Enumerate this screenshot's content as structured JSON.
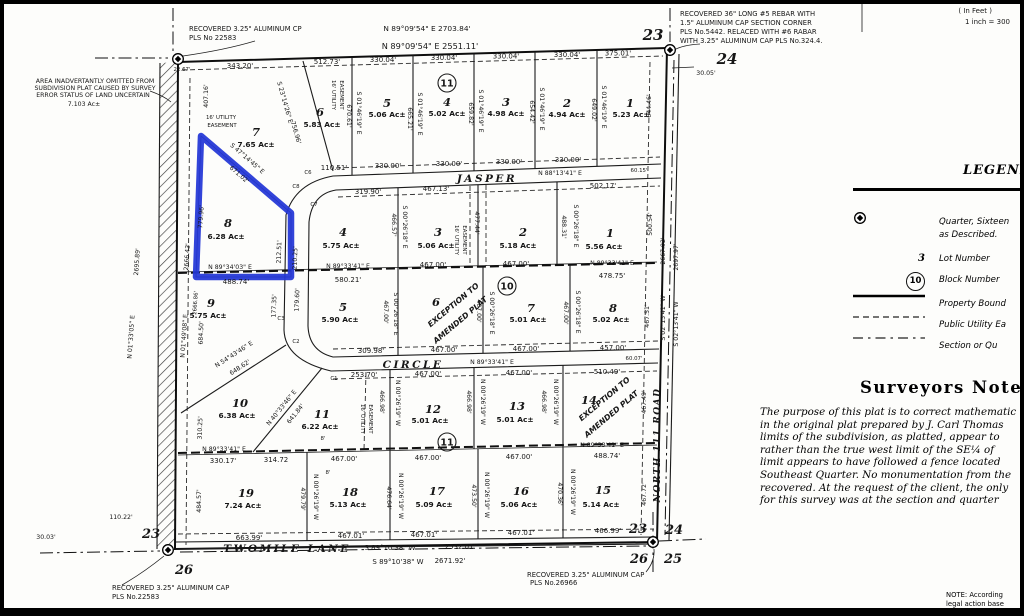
{
  "colors": {
    "highlight": "#2236d6"
  },
  "scale": {
    "l1": "( In Feet )",
    "l2": "1 inch = 300"
  },
  "notes": {
    "tl1": "RECOVERED 3.25\" ALUMINUM CP",
    "tl2": "PLS No 22583",
    "tr1": "RECOVERED 36\" LONG #5 REBAR WITH",
    "tr2": "1.5\" ALUMINUM CAP SECTION CORNER",
    "tr3": "PLS No.5442. RELACED WITH #6 RABAR",
    "tr4": "WITH 3.25\" ALUMINUM CAP PLS No.324.4.",
    "bl1": "RECOVERED 3.25\" ALUMINUM CAP",
    "bl2": "PLS No.22583",
    "br1": "RECOVERED 3.25\" ALUMINUM CAP",
    "br2": "PLS No.26966",
    "om1": "AREA INADVERTANTLY OMITTED FROM",
    "om2": "SUBDIVISION PLAT CAUSED BY SURVEY",
    "om3": "ERROR  STATUS OF LAND UNCERTAIN",
    "om4": "7.103 Ac±",
    "note_br1": "NOTE: According",
    "note_br2": "legal action base"
  },
  "sec": {
    "n23": "23",
    "n24": "24",
    "n25": "25",
    "n26": "26"
  },
  "streets": {
    "jasper": "JASPER",
    "circle": "CIRCLE",
    "twomile": "TWOMILE LANE",
    "north111": "NORTH 111 ROAD"
  },
  "blocks": {
    "b11": "11",
    "b10": "10"
  },
  "exception": {
    "l1": "EXCEPTION TO",
    "l2": "AMENDED PLAT"
  },
  "easement": {
    "l1": "16' UTILITY",
    "l2": "EASEMENT",
    "w8": "8'"
  },
  "lots": {
    "b11_7": {
      "n": "7",
      "a": "7.65 Ac±"
    },
    "b11_6": {
      "n": "6",
      "a": "5.83 Ac±"
    },
    "b11_5": {
      "n": "5",
      "a": "5.06 Ac±"
    },
    "b11_4": {
      "n": "4",
      "a": "5.02 Ac±"
    },
    "b11_3": {
      "n": "3",
      "a": "4.98 Ac±"
    },
    "b11_2": {
      "n": "2",
      "a": "4.94 Ac±"
    },
    "b11_1": {
      "n": "1",
      "a": "5.23 Ac±"
    },
    "r2_8": {
      "n": "8",
      "a": "6.28 Ac±"
    },
    "r2_4": {
      "n": "4",
      "a": "5.75 Ac±"
    },
    "r2_3": {
      "n": "3",
      "a": "5.06 Ac±"
    },
    "r2_2": {
      "n": "2",
      "a": "5.18 Ac±"
    },
    "r2_1": {
      "n": "1",
      "a": "5.56 Ac±"
    },
    "r3_9": {
      "n": "9",
      "a": "5.75 Ac±"
    },
    "r3_5": {
      "n": "5",
      "a": "5.90 Ac±"
    },
    "r3_6": {
      "n": "6"
    },
    "r3_7": {
      "n": "7",
      "a": "5.01 Ac±"
    },
    "r3_8": {
      "n": "8",
      "a": "5.02 Ac±"
    },
    "r4_10": {
      "n": "10",
      "a": "6.38 Ac±"
    },
    "r4_11": {
      "n": "11",
      "a": "6.22 Ac±"
    },
    "r4_12": {
      "n": "12",
      "a": "5.01 Ac±"
    },
    "r4_13": {
      "n": "13",
      "a": "5.01 Ac±"
    },
    "r4_14": {
      "n": "14"
    },
    "r5_19": {
      "n": "19",
      "a": "7.24 Ac±"
    },
    "r5_18": {
      "n": "18",
      "a": "5.13 Ac±"
    },
    "r5_17": {
      "n": "17",
      "a": "5.09 Ac±"
    },
    "r5_16": {
      "n": "16",
      "a": "5.06 Ac±"
    },
    "r5_15": {
      "n": "15",
      "a": "5.14 Ac±"
    }
  },
  "vals": {
    "n890954e_2703": "N 89°09'54\" E   2703.84'",
    "n890954e_2551": "N 89°09'54\" E   2551.11'",
    "d343_20": "343.20'",
    "d512_73": "512.73'",
    "d330_04": "330.04'",
    "d375_01": "375.01'",
    "d407_16": "407.16'",
    "d22_67": "22.67'",
    "s014619e": "S 01°46'19\" E",
    "d670_61": "670.61'",
    "d665_21": "665.21'",
    "d659_82": "659.82'",
    "d654_42": "654.42'",
    "d649_02": "649.02'",
    "d644_46": "644.46'",
    "s231426e": "S 23°14'26\" E",
    "d756_96": "756.96'",
    "c1": "C1",
    "c2": "C2",
    "c3": "C3",
    "c6": "C6",
    "c7": "C7",
    "c8": "C8",
    "d110_51": "110.51'",
    "d330_00": "330.00'",
    "n881341e": "N 88°13'41\" E",
    "d60_15": "60.15'",
    "d30_05": "30.05'",
    "d319_90": "319.90'",
    "d467_13": "467.13'",
    "d502_17": "502.17'",
    "s002618e": "S 00°26'18\" E",
    "d466_57": "466.57'",
    "d477_44": "477.44'",
    "d488_31": "488.31'",
    "d500_54": "500.54'",
    "s471445e": "S 47°14'45\" E",
    "d671_02": "671.02'",
    "d779_96": "779.96'",
    "d212_51": "212.51'",
    "d210_25": "210.25'",
    "n893403e": "N 89°34'03\" E",
    "n893341e": "N 89°33'41\" E",
    "d488_74": "488.74'",
    "d580_21": "580.21'",
    "d467_00": "467.00'",
    "d478_75": "478.75'",
    "d177_35": "177.35'",
    "d179_60": "179.60'",
    "d684_50": "684.50'",
    "n014908e": "N 01°49'08\" E",
    "d2666_43": "2666.43'",
    "d2666_86": "2666.86'",
    "n013305e": "N 01°33'05\" E",
    "d2695_89": "2695.89'",
    "n544346e": "N 54°43'46\" E",
    "d648_62": "648.62'",
    "d309_98": "309.98'",
    "d253_70": "253.70'",
    "d457_00": "457.00'",
    "d60_07": "60.07'",
    "d467_51": "467.51'",
    "s021341w": "S 02°13'41\" W",
    "d2667_92": "2667.92'",
    "d2697_97": "2697.97'",
    "n403346e": "N 40°33'46\" E",
    "d641_84": "641.84'",
    "d310_25": "310.25'",
    "d330_17": "330.17'",
    "d314_72": "314.72",
    "d466_98": "466.98'",
    "n002619w": "N 00°26'19\" W",
    "d510_49": "510.49'",
    "d467_49": "467.49'",
    "d484_57": "484.57'",
    "d479_79": "479.79'",
    "d476_64": "476.64'",
    "d473_50": "473.50'",
    "d470_36": "470.36'",
    "d467_72": "467.72'",
    "d663_99": "663.99'",
    "d467_01": "467.01'",
    "d466_99": "466.99'",
    "s891038w": "S 89°10'38\" W",
    "d2532_01": "2532.01'",
    "d2671_92": "2671.92'",
    "d110_22": "110.22'",
    "d30_03": "30.03'"
  },
  "legend": {
    "title": "LEGEND",
    "quarter1": "Quarter, Sixteen",
    "quarter2": "as Described.",
    "lot_sym": "3",
    "lot_label": "Lot Number",
    "block_sym": "10",
    "block_label": "Block Number",
    "boundary_label": "Property Bound",
    "utility_label": "Public Utility Ea",
    "section_label": "Section   or   Qu"
  },
  "surveyors": {
    "title": "Surveyors Note:",
    "lines": [
      "The purpose of this plat is to correct mathematic",
      "in the original plat prepared by J. Carl Thomas",
      "limits of the subdivision, as platted, appear to",
      "rather than the true west limit of the SE¼ of",
      "limit appears to have followed a fence located",
      "Southeast Quarter. No monumentation from the",
      "recovered. At the request of the client, the only",
      "for this survey was at the section and quarter"
    ]
  }
}
